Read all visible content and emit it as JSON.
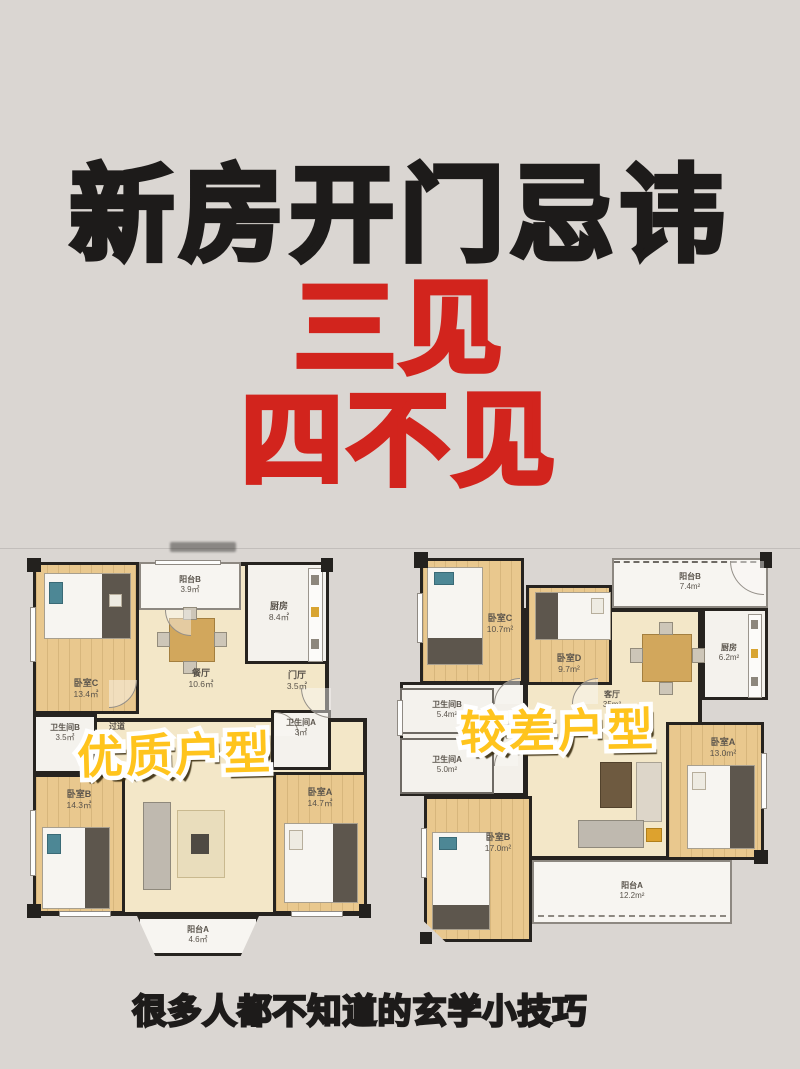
{
  "page": {
    "title": "新房开门忌讳",
    "subtitle_line1": "三见",
    "subtitle_line2": "四不见",
    "caption": "很多人都不知道的玄学小技巧",
    "title_color": "#1d1b1a",
    "accent_red": "#d2241d",
    "overlay_yellow": "#ffc41d",
    "background": "#dad6d2"
  },
  "plans": {
    "good": {
      "label": "优质户型",
      "rooms": [
        {
          "name": "卧室C",
          "area": "13.4㎡"
        },
        {
          "name": "阳台B",
          "area": "3.9㎡"
        },
        {
          "name": "厨房",
          "area": "8.4㎡"
        },
        {
          "name": "餐厅",
          "area": "10.6㎡"
        },
        {
          "name": "门厅",
          "area": "3.5㎡"
        },
        {
          "name": "卫生间B",
          "area": "3.5㎡"
        },
        {
          "name": "卫生间A",
          "area": "3㎡"
        },
        {
          "name": "过道",
          "area": ""
        },
        {
          "name": "卧室B",
          "area": "14.3㎡"
        },
        {
          "name": "卧室A",
          "area": "14.7㎡"
        },
        {
          "name": "阳台A",
          "area": "4.6㎡"
        }
      ]
    },
    "bad": {
      "label": "较差户型",
      "rooms": [
        {
          "name": "卧室C",
          "area": "10.7m²"
        },
        {
          "name": "卧室D",
          "area": "9.7m²"
        },
        {
          "name": "阳台B",
          "area": "7.4m²"
        },
        {
          "name": "厨房",
          "area": "6.2m²"
        },
        {
          "name": "卫生间B",
          "area": "5.4m²"
        },
        {
          "name": "卫生间A",
          "area": "5.0m²"
        },
        {
          "name": "客厅",
          "area": "35m²"
        },
        {
          "name": "卧室B",
          "area": "17.0m²"
        },
        {
          "name": "卧室A",
          "area": "13.0m²"
        },
        {
          "name": "阳台A",
          "area": "12.2m²"
        }
      ]
    }
  }
}
